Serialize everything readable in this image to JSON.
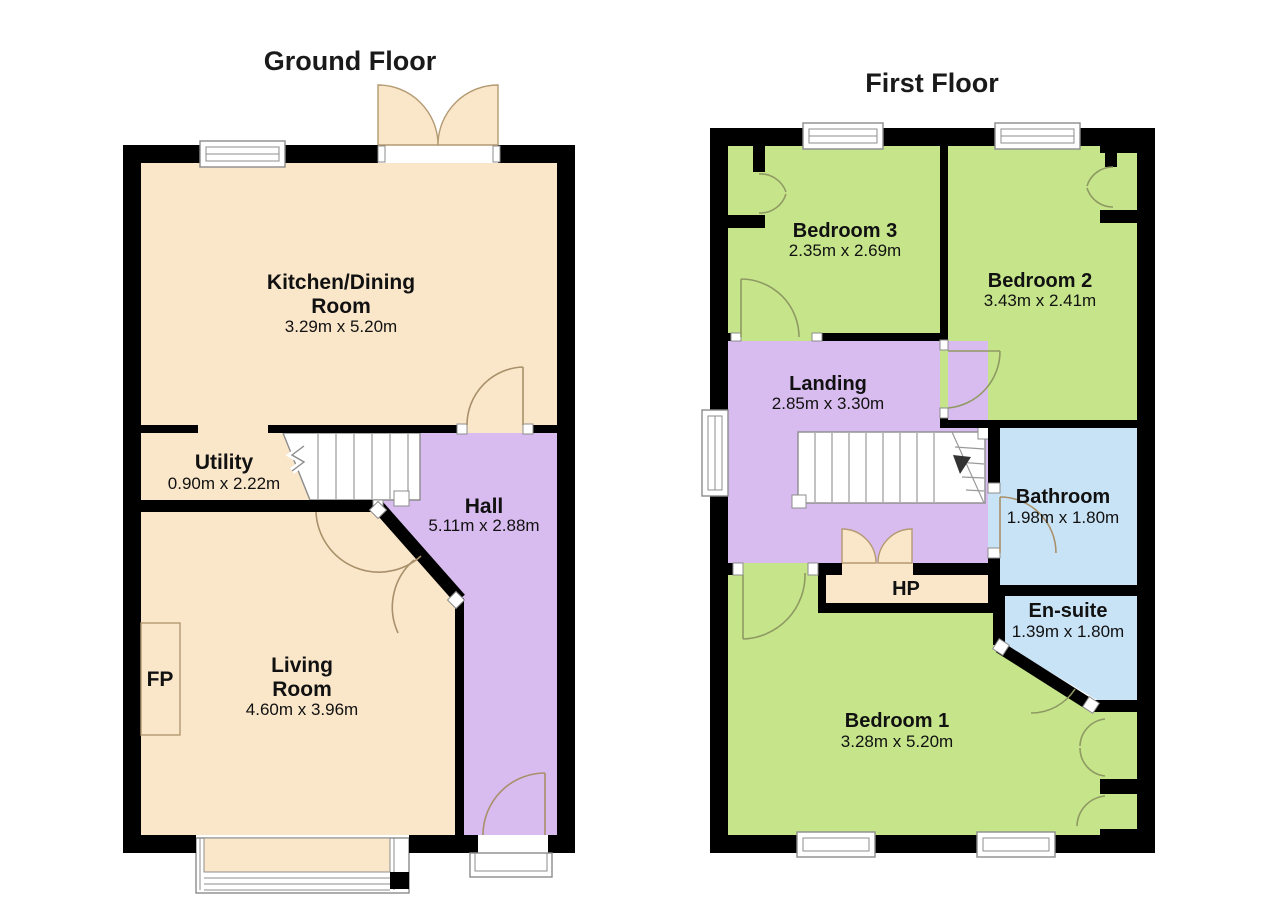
{
  "colors": {
    "floor_cream": "#FAE7CA",
    "hall_purple": "#D9BCEF",
    "bedroom_green": "#C6E58B",
    "bath_blue": "#C9E3F6",
    "wall_black": "#000000"
  },
  "ground_floor": {
    "title": "Ground Floor",
    "rooms": {
      "kitchen": {
        "name_line1": "Kitchen/Dining",
        "name_line2": "Room",
        "dims": "3.29m x 5.20m"
      },
      "utility": {
        "name": "Utility",
        "dims": "0.90m x 2.22m"
      },
      "hall": {
        "name": "Hall",
        "dims": "5.11m x 2.88m"
      },
      "living": {
        "name_line1": "Living",
        "name_line2": "Room",
        "dims": "4.60m x 3.96m"
      },
      "fireplace": {
        "label": "FP"
      }
    }
  },
  "first_floor": {
    "title": "First Floor",
    "rooms": {
      "bedroom3": {
        "name": "Bedroom 3",
        "dims": "2.35m x 2.69m"
      },
      "bedroom2": {
        "name": "Bedroom 2",
        "dims": "3.43m x 2.41m"
      },
      "landing": {
        "name": "Landing",
        "dims": "2.85m x 3.30m"
      },
      "bathroom": {
        "name": "Bathroom",
        "dims": "1.98m x 1.80m"
      },
      "hot_press": {
        "label": "HP"
      },
      "ensuite": {
        "name": "En-suite",
        "dims": "1.39m x 1.80m"
      },
      "bedroom1": {
        "name": "Bedroom 1",
        "dims": "3.28m x 5.20m"
      }
    }
  }
}
